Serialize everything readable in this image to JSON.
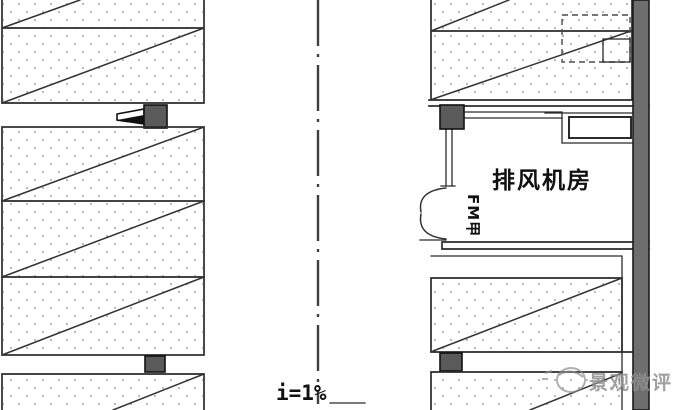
{
  "drawing": {
    "room_label": "排风机房",
    "slope_label": "i=1%",
    "door_tag": "FM甲",
    "watermark": "景观微评"
  },
  "colors": {
    "line": "#2b2b2b",
    "wall_fill": "#6e6e6e",
    "column_fill": "#5a5a5a",
    "dot": "#a6a6ac",
    "watermark_color": "#8f8f8f",
    "background": "#ffffff"
  },
  "icons": {
    "jet_fan": "jet-fan-symbol",
    "column_marker": "filled-square-column",
    "door": "double-swing-door",
    "centerline": "dash-dot-centerline",
    "watermark_logo": "aperture-circle"
  }
}
